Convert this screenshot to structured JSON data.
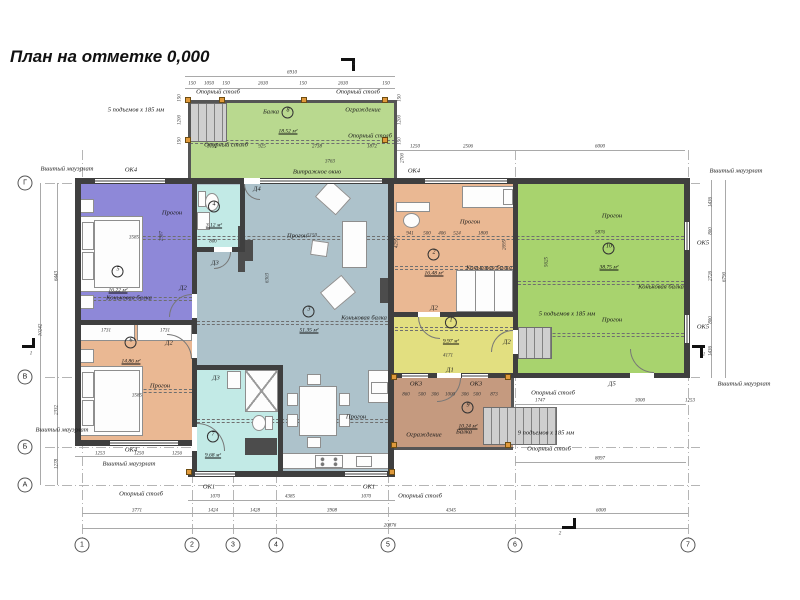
{
  "title": "План на отметке 0,000",
  "colors": {
    "terrace_green": "#b9d98f",
    "room_green": "#a8d36e",
    "purple": "#8e88d8",
    "orange": "#eab893",
    "teal": "#c2eae6",
    "bluegray": "#adc2cb",
    "yellow": "#e2df80",
    "brown": "#c59a7f",
    "wall": "#3f3f3f"
  },
  "plan": {
    "rooms": [
      {
        "num": "5",
        "area": "16.22 м²",
        "x": 118,
        "y": 281
      },
      {
        "num": "4",
        "area": "3.12 м²",
        "x": 214,
        "y": 216
      },
      {
        "num": "6",
        "area": "14.86 м²",
        "x": 131,
        "y": 352
      },
      {
        "num": "7",
        "area": "9.68 м²",
        "x": 213,
        "y": 446
      },
      {
        "num": "3",
        "area": "51.35 м²",
        "x": 309,
        "y": 321
      },
      {
        "num": "2",
        "area": "16.48 м²",
        "x": 434,
        "y": 264
      },
      {
        "num": "1",
        "area": "9.97 м²",
        "x": 451,
        "y": 332
      },
      {
        "num": "8",
        "area": "18.52 м²",
        "x": 288,
        "y": 122
      },
      {
        "num": "9",
        "area": "10.24 м²",
        "x": 468,
        "y": 417
      },
      {
        "num": "10",
        "area": "38.75 м²",
        "x": 609,
        "y": 258
      }
    ],
    "annotations": [
      {
        "t": "Опорный столб",
        "x": 218,
        "y": 92
      },
      {
        "t": "Опорный столб",
        "x": 358,
        "y": 92
      },
      {
        "t": "Балка",
        "x": 271,
        "y": 112
      },
      {
        "t": "Ограждение",
        "x": 363,
        "y": 110
      },
      {
        "t": "5 подъемов x 185 мм",
        "x": 136,
        "y": 110
      },
      {
        "t": "Опорный столб",
        "x": 226,
        "y": 145
      },
      {
        "t": "Опорный столб",
        "x": 370,
        "y": 136
      },
      {
        "t": "Вшитый мауэрлат",
        "x": 67,
        "y": 169
      },
      {
        "t": "ОК4",
        "x": 131,
        "y": 170
      },
      {
        "t": "Витражное окно",
        "x": 317,
        "y": 172
      },
      {
        "t": "ОК4",
        "x": 414,
        "y": 171
      },
      {
        "t": "Вшитый мауэрлат",
        "x": 736,
        "y": 171
      },
      {
        "t": "Д4",
        "x": 257,
        "y": 189
      },
      {
        "t": "Д3",
        "x": 215,
        "y": 263
      },
      {
        "t": "Д2",
        "x": 183,
        "y": 288
      },
      {
        "t": "Д2",
        "x": 169,
        "y": 343
      },
      {
        "t": "Д3",
        "x": 216,
        "y": 378
      },
      {
        "t": "Прогон",
        "x": 172,
        "y": 213
      },
      {
        "t": "Коньковая балка",
        "x": 129,
        "y": 298
      },
      {
        "t": "Прогон",
        "x": 160,
        "y": 386
      },
      {
        "t": "Прогон",
        "x": 297,
        "y": 236
      },
      {
        "t": "Коньковая балка",
        "x": 364,
        "y": 318
      },
      {
        "t": "Прогон",
        "x": 356,
        "y": 417
      },
      {
        "t": "Прогон",
        "x": 470,
        "y": 222
      },
      {
        "t": "Коньковая балка",
        "x": 489,
        "y": 268
      },
      {
        "t": "Прогон",
        "x": 612,
        "y": 216
      },
      {
        "t": "Коньковая балка",
        "x": 661,
        "y": 287
      },
      {
        "t": "Прогон",
        "x": 612,
        "y": 320
      },
      {
        "t": "5 подъемов x 185 мм",
        "x": 567,
        "y": 314
      },
      {
        "t": "Д2",
        "x": 434,
        "y": 308
      },
      {
        "t": "Д2",
        "x": 507,
        "y": 342
      },
      {
        "t": "Д1",
        "x": 450,
        "y": 370
      },
      {
        "t": "Д5",
        "x": 612,
        "y": 384
      },
      {
        "t": "ОК3",
        "x": 416,
        "y": 384
      },
      {
        "t": "ОК3",
        "x": 476,
        "y": 384
      },
      {
        "t": "Ограждение",
        "x": 424,
        "y": 435
      },
      {
        "t": "Балка",
        "x": 464,
        "y": 432
      },
      {
        "t": "9 подъемов x 185 мм",
        "x": 546,
        "y": 433
      },
      {
        "t": "Опорный столб",
        "x": 549,
        "y": 449
      },
      {
        "t": "Опорный столб",
        "x": 553,
        "y": 393
      },
      {
        "t": "ОК5",
        "x": 703,
        "y": 243
      },
      {
        "t": "ОК5",
        "x": 703,
        "y": 327
      },
      {
        "t": "Вшитый мауэрлат",
        "x": 744,
        "y": 384
      },
      {
        "t": "ОК4",
        "x": 131,
        "y": 450
      },
      {
        "t": "Вшитый мауэрлат",
        "x": 129,
        "y": 464
      },
      {
        "t": "Вшитый мауэрлат",
        "x": 62,
        "y": 430
      },
      {
        "t": "Опорный столб",
        "x": 141,
        "y": 494
      },
      {
        "t": "Опорный столб",
        "x": 420,
        "y": 496
      },
      {
        "t": "ОК1",
        "x": 209,
        "y": 487
      },
      {
        "t": "ОК1",
        "x": 369,
        "y": 487
      }
    ],
    "dimensions": [
      {
        "t": "6910",
        "x": 292,
        "y": 73
      },
      {
        "t": "150",
        "x": 192,
        "y": 84
      },
      {
        "t": "1050",
        "x": 209,
        "y": 84
      },
      {
        "t": "150",
        "x": 226,
        "y": 84
      },
      {
        "t": "2630",
        "x": 263,
        "y": 84
      },
      {
        "t": "150",
        "x": 303,
        "y": 84
      },
      {
        "t": "2630",
        "x": 343,
        "y": 84
      },
      {
        "t": "150",
        "x": 386,
        "y": 84
      },
      {
        "t": "150",
        "x": 180,
        "y": 98,
        "r": 1
      },
      {
        "t": "1200",
        "x": 180,
        "y": 120,
        "r": 1
      },
      {
        "t": "150",
        "x": 180,
        "y": 141,
        "r": 1
      },
      {
        "t": "150",
        "x": 400,
        "y": 98,
        "r": 1
      },
      {
        "t": "1200",
        "x": 400,
        "y": 120,
        "r": 1
      },
      {
        "t": "150",
        "x": 400,
        "y": 141,
        "r": 1
      },
      {
        "t": "2700",
        "x": 403,
        "y": 158,
        "r": 1
      },
      {
        "t": "3132",
        "x": 212,
        "y": 147
      },
      {
        "t": "925",
        "x": 262,
        "y": 147
      },
      {
        "t": "2738",
        "x": 317,
        "y": 147
      },
      {
        "t": "1872",
        "x": 372,
        "y": 147
      },
      {
        "t": "3763",
        "x": 330,
        "y": 162
      },
      {
        "t": "1250",
        "x": 415,
        "y": 147
      },
      {
        "t": "2506",
        "x": 468,
        "y": 147
      },
      {
        "t": "6000",
        "x": 600,
        "y": 147
      },
      {
        "t": "6443",
        "x": 57,
        "y": 276,
        "r": 1
      },
      {
        "t": "2332",
        "x": 57,
        "y": 410,
        "r": 1
      },
      {
        "t": "1278",
        "x": 57,
        "y": 464,
        "r": 1
      },
      {
        "t": "10242",
        "x": 41,
        "y": 330,
        "r": 1
      },
      {
        "t": "1436",
        "x": 711,
        "y": 202,
        "r": 1
      },
      {
        "t": "800",
        "x": 711,
        "y": 231,
        "r": 1
      },
      {
        "t": "2726",
        "x": 711,
        "y": 276,
        "r": 1
      },
      {
        "t": "800",
        "x": 711,
        "y": 320,
        "r": 1
      },
      {
        "t": "1436",
        "x": 711,
        "y": 351,
        "r": 1
      },
      {
        "t": "6790",
        "x": 725,
        "y": 277,
        "r": 1
      },
      {
        "t": "3771",
        "x": 137,
        "y": 511
      },
      {
        "t": "1424",
        "x": 213,
        "y": 511
      },
      {
        "t": "1428",
        "x": 255,
        "y": 511
      },
      {
        "t": "3908",
        "x": 332,
        "y": 511
      },
      {
        "t": "4345",
        "x": 451,
        "y": 511
      },
      {
        "t": "6000",
        "x": 601,
        "y": 511
      },
      {
        "t": "20876",
        "x": 390,
        "y": 526
      },
      {
        "t": "1070",
        "x": 215,
        "y": 497
      },
      {
        "t": "4385",
        "x": 290,
        "y": 497
      },
      {
        "t": "1070",
        "x": 366,
        "y": 497
      },
      {
        "t": "1253",
        "x": 100,
        "y": 454
      },
      {
        "t": "1250",
        "x": 139,
        "y": 454
      },
      {
        "t": "1256",
        "x": 177,
        "y": 454
      },
      {
        "t": "860",
        "x": 406,
        "y": 395
      },
      {
        "t": "500",
        "x": 422,
        "y": 395
      },
      {
        "t": "306",
        "x": 435,
        "y": 395
      },
      {
        "t": "1000",
        "x": 450,
        "y": 395
      },
      {
        "t": "306",
        "x": 465,
        "y": 395
      },
      {
        "t": "500",
        "x": 477,
        "y": 395
      },
      {
        "t": "873",
        "x": 494,
        "y": 395
      },
      {
        "t": "1747",
        "x": 540,
        "y": 401
      },
      {
        "t": "3000",
        "x": 640,
        "y": 401
      },
      {
        "t": "1253",
        "x": 690,
        "y": 401
      },
      {
        "t": "8097",
        "x": 600,
        "y": 459
      },
      {
        "t": "3585",
        "x": 134,
        "y": 238
      },
      {
        "t": "2987",
        "x": 162,
        "y": 236,
        "r": 1
      },
      {
        "t": "3585",
        "x": 137,
        "y": 396
      },
      {
        "t": "800",
        "x": 213,
        "y": 242
      },
      {
        "t": "5150",
        "x": 312,
        "y": 236
      },
      {
        "t": "6303",
        "x": 268,
        "y": 278,
        "r": 1
      },
      {
        "t": "941",
        "x": 410,
        "y": 234
      },
      {
        "t": "500",
        "x": 427,
        "y": 234
      },
      {
        "t": "406",
        "x": 442,
        "y": 234
      },
      {
        "t": "524",
        "x": 457,
        "y": 234
      },
      {
        "t": "1800",
        "x": 483,
        "y": 234
      },
      {
        "t": "4295",
        "x": 397,
        "y": 243,
        "r": 1
      },
      {
        "t": "2695",
        "x": 505,
        "y": 245,
        "r": 1
      },
      {
        "t": "5876",
        "x": 600,
        "y": 233
      },
      {
        "t": "5625",
        "x": 547,
        "y": 262,
        "r": 1
      },
      {
        "t": "4171",
        "x": 448,
        "y": 356
      },
      {
        "t": "1731",
        "x": 106,
        "y": 331
      },
      {
        "t": "1731",
        "x": 165,
        "y": 331
      },
      {
        "t": "2",
        "x": 354,
        "y": 64
      },
      {
        "t": "2",
        "x": 560,
        "y": 534
      },
      {
        "t": "1",
        "x": 31,
        "y": 354
      },
      {
        "t": "1",
        "x": 704,
        "y": 355
      }
    ],
    "axes": {
      "bottom": [
        {
          "label": "1",
          "x": 82
        },
        {
          "label": "2",
          "x": 192
        },
        {
          "label": "3",
          "x": 233
        },
        {
          "label": "4",
          "x": 276
        },
        {
          "label": "5",
          "x": 388
        },
        {
          "label": "6",
          "x": 515
        },
        {
          "label": "7",
          "x": 688
        }
      ],
      "bottom_y": 545,
      "left": [
        {
          "label": "Г",
          "y": 183
        },
        {
          "label": "В",
          "y": 377
        },
        {
          "label": "Б",
          "y": 447
        },
        {
          "label": "А",
          "y": 485
        }
      ],
      "left_x": 25
    }
  }
}
